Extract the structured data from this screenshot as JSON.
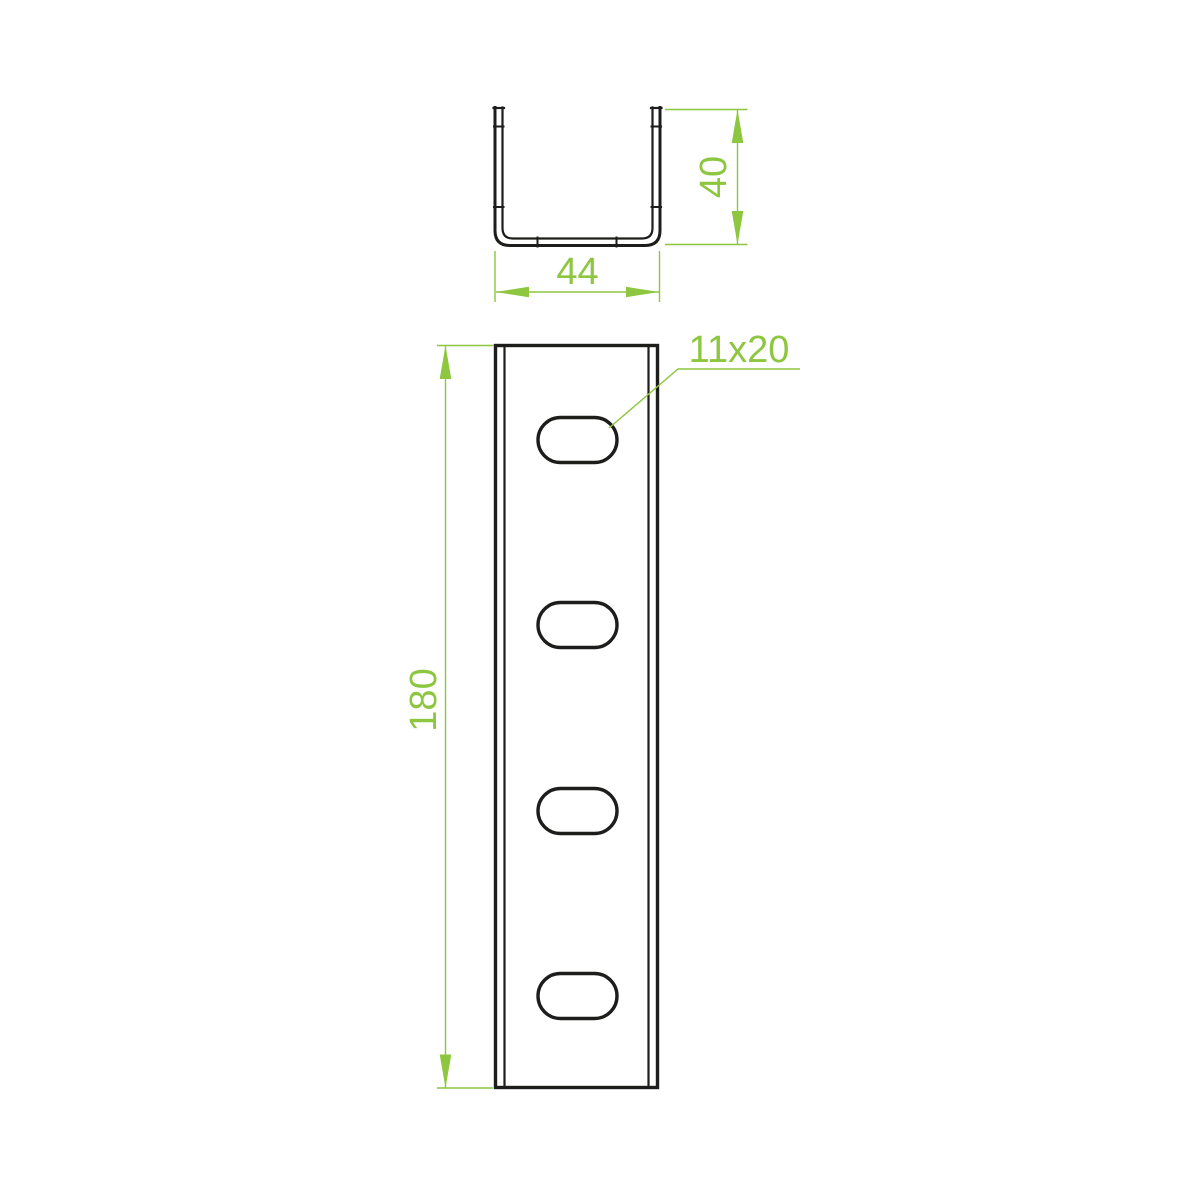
{
  "drawing": {
    "background_color": "#ffffff",
    "line_color": "#1d1d1b",
    "dimension_color": "#8dc63f",
    "cross_section_view": {
      "width_dimension": "44",
      "height_dimension": "40"
    },
    "front_view": {
      "length_dimension": "180",
      "slot_size_label": "11x20",
      "slot_count": 4
    }
  }
}
